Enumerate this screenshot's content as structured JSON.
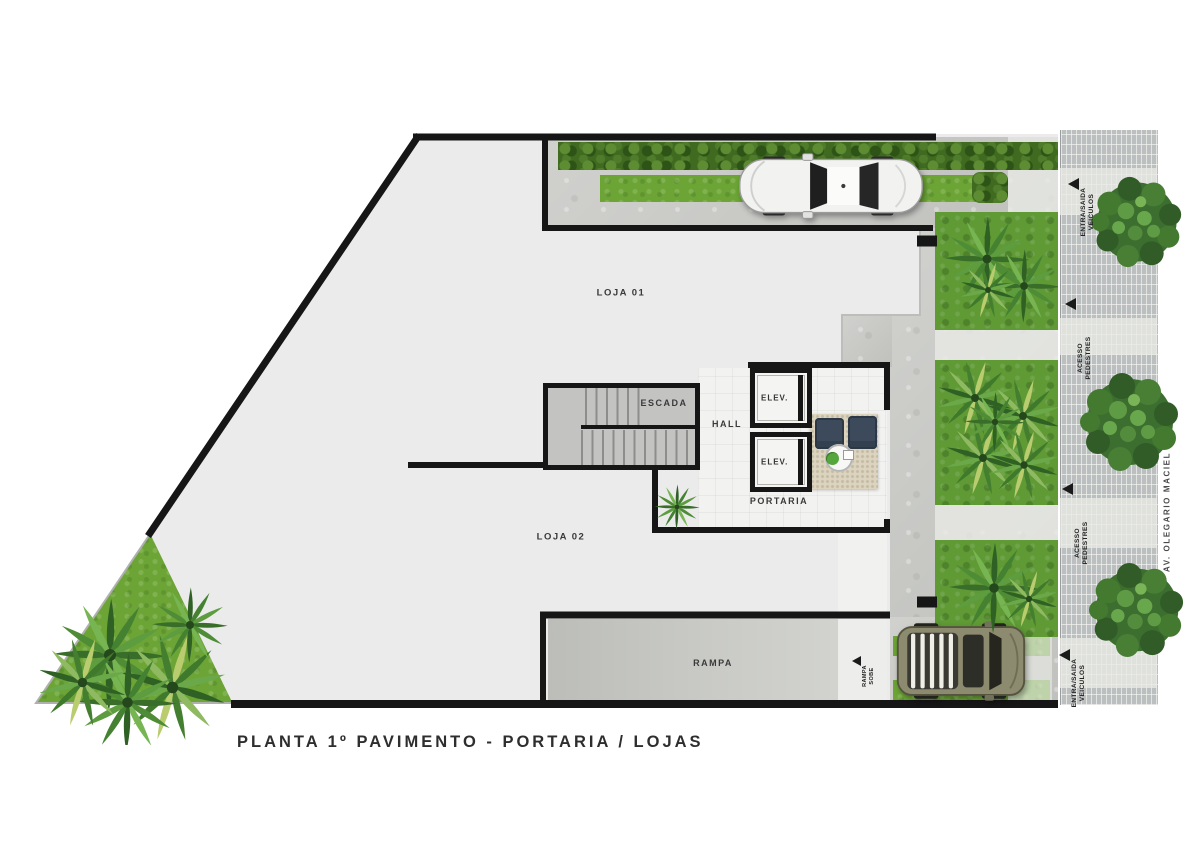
{
  "title": "PLANTA 1º PAVIMENTO - PORTARIA / LOJAS",
  "rooms": {
    "loja01": "LOJA 01",
    "loja02": "LOJA 02",
    "escada": "ESCADA",
    "hall": "HALL",
    "elev": "ELEV.",
    "portaria": "PORTARIA",
    "rampa": "RAMPA"
  },
  "ramp_direction": {
    "line1": "RAMPA",
    "line2": "SOBE"
  },
  "street": {
    "name": "AV. OLEGARIO MACIEL"
  },
  "access": [
    {
      "line1": "ENTRA/SAIDA",
      "line2": "VEICULOS"
    },
    {
      "line1": "ACESSO",
      "line2": "PEDESTRES"
    },
    {
      "line1": "ACESSO",
      "line2": "PEDESTRES"
    },
    {
      "line1": "ENTRA/SAIDA",
      "line2": "VEICULOS"
    }
  ],
  "colors": {
    "wall": "#161616",
    "floor": "#ebebeb",
    "concrete": "#cacbc7",
    "grass": "#6ca536",
    "hedge": "#3f6a20",
    "sidewalk_tile": "#bcbfc0",
    "rug": "#dcd4bf",
    "armchair": "#3d4a5c",
    "car_top": "#f2f2f1",
    "car_bottom": "#8c8b6f"
  }
}
